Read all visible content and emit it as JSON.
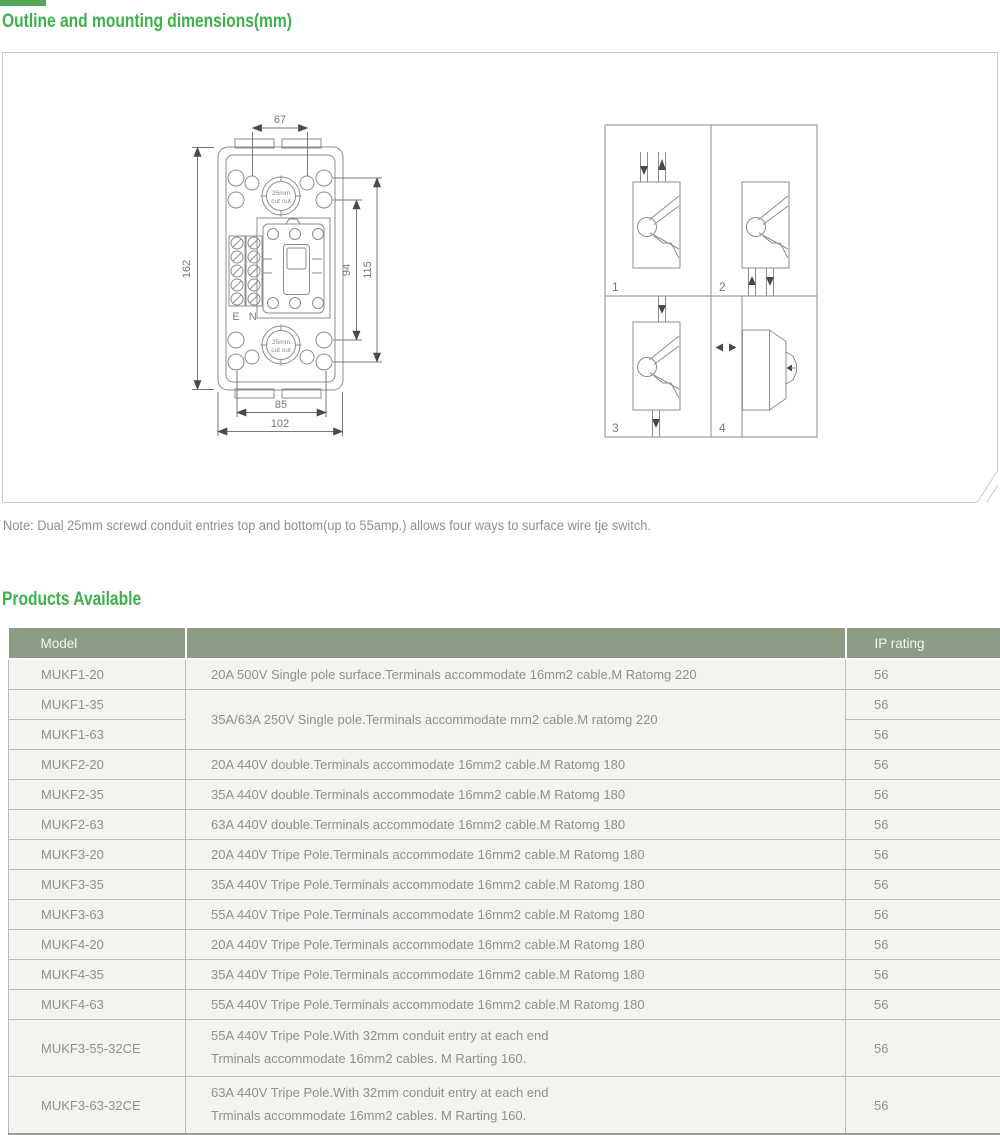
{
  "page": {
    "section1_title": "Outline and mounting dimensions(mm)",
    "section2_title": "Products Available",
    "note": "Note: Dual 25mm screwd conduit entries top and bottom(up to 55amp.) allows four ways to surface wire tje switch."
  },
  "colors": {
    "accent_green": "#3db14c",
    "table_header_bg": "#8d9c85",
    "row_bg": "#f3f3f0",
    "drawing_line": "#8c8c8c"
  },
  "diagram": {
    "front_view": {
      "dim_top_width": "67",
      "dim_left_height": "162",
      "dim_right_inner": "94",
      "dim_right_outer": "115",
      "dim_bottom_inner": "85",
      "dim_bottom_outer": "102",
      "cutout_line1": "25mm",
      "cutout_line2": "cut out",
      "terminals_label": "E N"
    },
    "mounting_views": {
      "labels": [
        "1",
        "2",
        "3",
        "4"
      ]
    }
  },
  "table": {
    "headers": {
      "model": "Model",
      "description": "",
      "ip_rating": "IP rating"
    },
    "rows": [
      {
        "model": "MUKF1-20",
        "desc": "20A 500V Single pole surface.Terminals accommodate 16mm2 cable.M Ratomg 220",
        "ip": "56"
      },
      {
        "model": "MUKF1-35",
        "desc": "35A/63A 250V Single pole.Terminals accommodate mm2 cable.M ratomg 220",
        "ip": "56"
      },
      {
        "model": "MUKF1-63",
        "ip": "56"
      },
      {
        "model": "MUKF2-20",
        "desc": "20A 440V double.Terminals accommodate 16mm2 cable.M Ratomg 180",
        "ip": "56"
      },
      {
        "model": "MUKF2-35",
        "desc": "35A 440V double.Terminals accommodate 16mm2 cable.M Ratomg 180",
        "ip": "56"
      },
      {
        "model": "MUKF2-63",
        "desc": "63A 440V double.Terminals accommodate 16mm2 cable.M Ratomg 180",
        "ip": "56"
      },
      {
        "model": "MUKF3-20",
        "desc": "20A 440V Tripe Pole.Terminals accommodate 16mm2 cable.M Ratomg 180",
        "ip": "56"
      },
      {
        "model": "MUKF3-35",
        "desc": "35A 440V Tripe Pole.Terminals accommodate 16mm2 cable.M Ratomg 180",
        "ip": "56"
      },
      {
        "model": "MUKF3-63",
        "desc": "55A 440V Tripe Pole.Terminals accommodate 16mm2 cable.M Ratomg 180",
        "ip": "56"
      },
      {
        "model": "MUKF4-20",
        "desc": "20A 440V Tripe Pole.Terminals accommodate 16mm2 cable.M Ratomg 180",
        "ip": "56"
      },
      {
        "model": "MUKF4-35",
        "desc": "35A 440V Tripe Pole.Terminals accommodate 16mm2 cable.M Ratomg 180",
        "ip": "56"
      },
      {
        "model": "MUKF4-63",
        "desc": "55A 440V Tripe Pole.Terminals accommodate 16mm2 cable.M Ratomg 180",
        "ip": "56"
      },
      {
        "model": "MUKF3-55-32CE",
        "desc_line1": "55A 440V Tripe Pole.With 32mm conduit entry at each end",
        "desc_line2": "Trminals accommodate 16mm2 cables. M Rarting 160.",
        "ip": "56"
      },
      {
        "model": "MUKF3-63-32CE",
        "desc_line1": "63A 440V Tripe Pole.With 32mm conduit entry at each end",
        "desc_line2": "Trminals accommodate 16mm2 cables. M Rarting 160.",
        "ip": "56"
      }
    ]
  }
}
